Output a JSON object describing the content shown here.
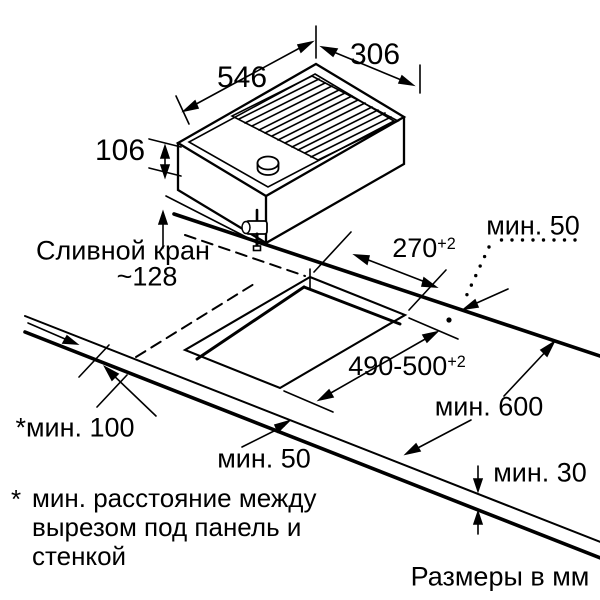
{
  "labels": {
    "dim_546": "546",
    "dim_306": "306",
    "dim_106": "106",
    "drain_line1": "Сливной кран",
    "drain_line2": "~128",
    "min50_top": "мин. 50",
    "dim_270": {
      "value": "270",
      "tol": "+2"
    },
    "dim_490": {
      "value": "490-500",
      "tol": "+2"
    },
    "min600": "мин. 600",
    "min100": "*мин. 100",
    "min50_bottom": "мин. 50",
    "min30": "мин. 30",
    "note_star": "*",
    "note_lines": [
      "мин. расстояние между",
      "вырезом под панель и",
      "стенкой"
    ],
    "units": "Размеры в мм"
  },
  "colors": {
    "ink": "#000000",
    "background": "#ffffff"
  }
}
